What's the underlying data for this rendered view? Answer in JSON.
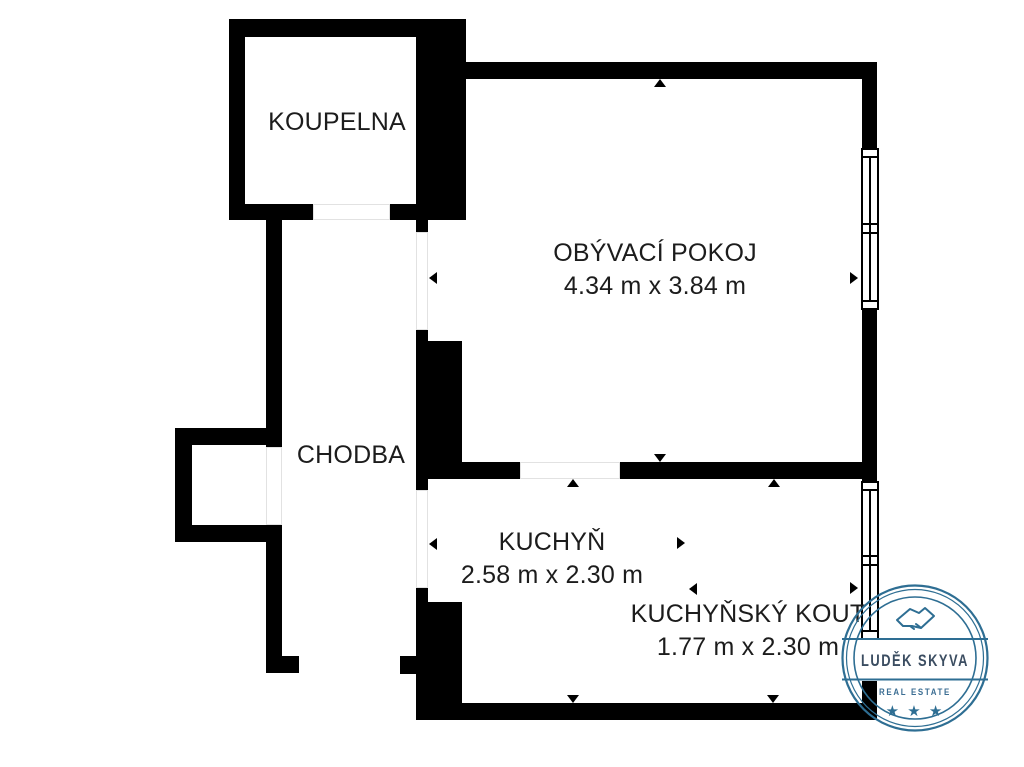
{
  "plan": {
    "title": "floor-plan",
    "rooms": {
      "koupelna": {
        "label": "KOUPELNA",
        "dimensions": ""
      },
      "chodba": {
        "label": "CHODBA",
        "dimensions": ""
      },
      "obyvaci_pokoj": {
        "label": "OBÝVACÍ POKOJ",
        "dimensions": "4.34 m x 3.84 m"
      },
      "kuchyn": {
        "label": "KUCHYŇ",
        "dimensions": "2.58 m x 2.30 m"
      },
      "kuchynsky_kout": {
        "label": "KUCHYŇSKÝ KOUT",
        "dimensions": "1.77 m x 2.30 m"
      }
    },
    "colors": {
      "walls": "#000000",
      "text": "#1c1c1c",
      "background": "#ffffff"
    }
  },
  "watermark": {
    "name": "LUDĚK SKYVA",
    "subtitle": "REAL ESTATE",
    "stars": "★ ★ ★",
    "icon": "handshake-icon",
    "colors": {
      "accent": "#2e6e93",
      "name_text": "#3b4d61",
      "subtitle_text": "#3c6e93"
    }
  }
}
